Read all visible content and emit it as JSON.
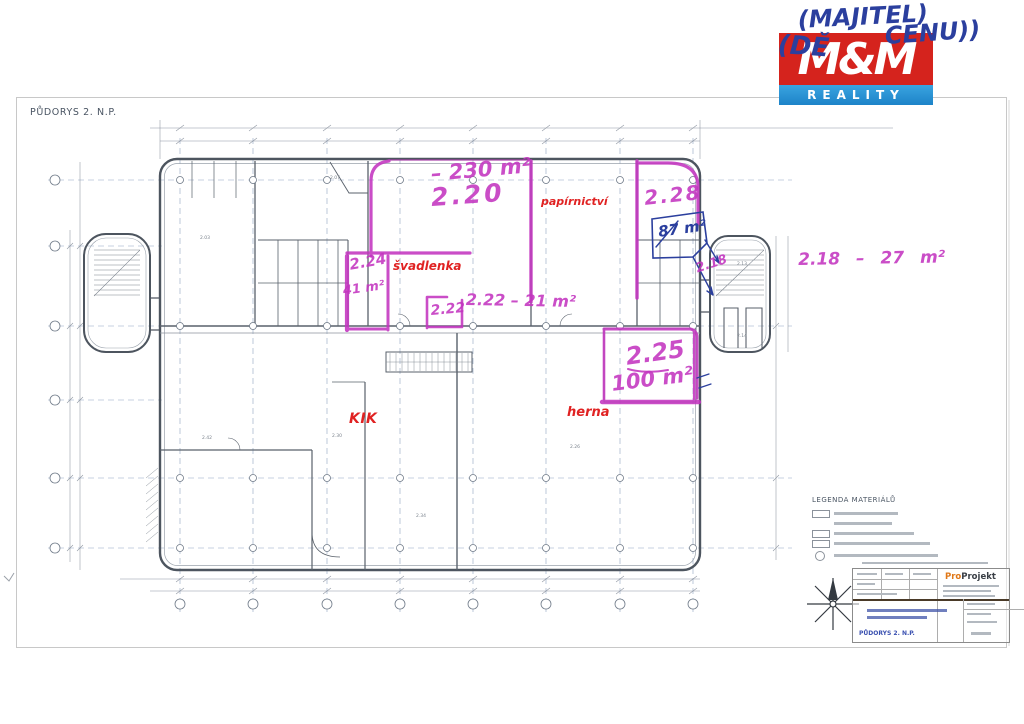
{
  "page_title": "PŮDORYS 2. N.P.",
  "logo": {
    "name_top": "M&M",
    "name_bottom": "REALITY"
  },
  "pen_notes": {
    "line1": "(MAJITEL)",
    "line2_left": "(DĚ",
    "line2_right": "CENU))",
    "area_87": "87 m²"
  },
  "marker_notes": {
    "room_220": "2.20",
    "room_220_area": "– 230 m²",
    "room_228": "2.28",
    "room_224": "2.24",
    "room_224_area": "41 m²",
    "room_222": "2.22",
    "room_222_note": "2.22  –  21 m²",
    "room_225": "2.25",
    "room_225_area": "100 m²",
    "room_218": "2.18",
    "room_218_note": "2.18 – 27 m²"
  },
  "red_labels": {
    "papirnictvi": "papírnictví",
    "svadlenka": "švadlenka",
    "kik": "KIK",
    "herna": "herna"
  },
  "legend": {
    "title": "LEGENDA MATERIÁLŮ"
  },
  "title_block": {
    "brand_pro": "Pro",
    "brand_projekt": "Projekt",
    "drawing_title": "PŮDORYS 2. N.P."
  },
  "plan_numbers": [
    {
      "text": "2.03"
    },
    {
      "text": "2.07"
    },
    {
      "text": "2.30"
    },
    {
      "text": "2.42"
    },
    {
      "text": "2.34"
    },
    {
      "text": "2.26"
    },
    {
      "text": "2.13"
    },
    {
      "text": "2.14"
    }
  ],
  "colors": {
    "marker": "#c335c0",
    "pen": "#2b3f9e",
    "red_label": "#e02222",
    "logo_red": "#d5231d",
    "logo_blue": "#2596d6",
    "brand_orange": "#e07818"
  }
}
